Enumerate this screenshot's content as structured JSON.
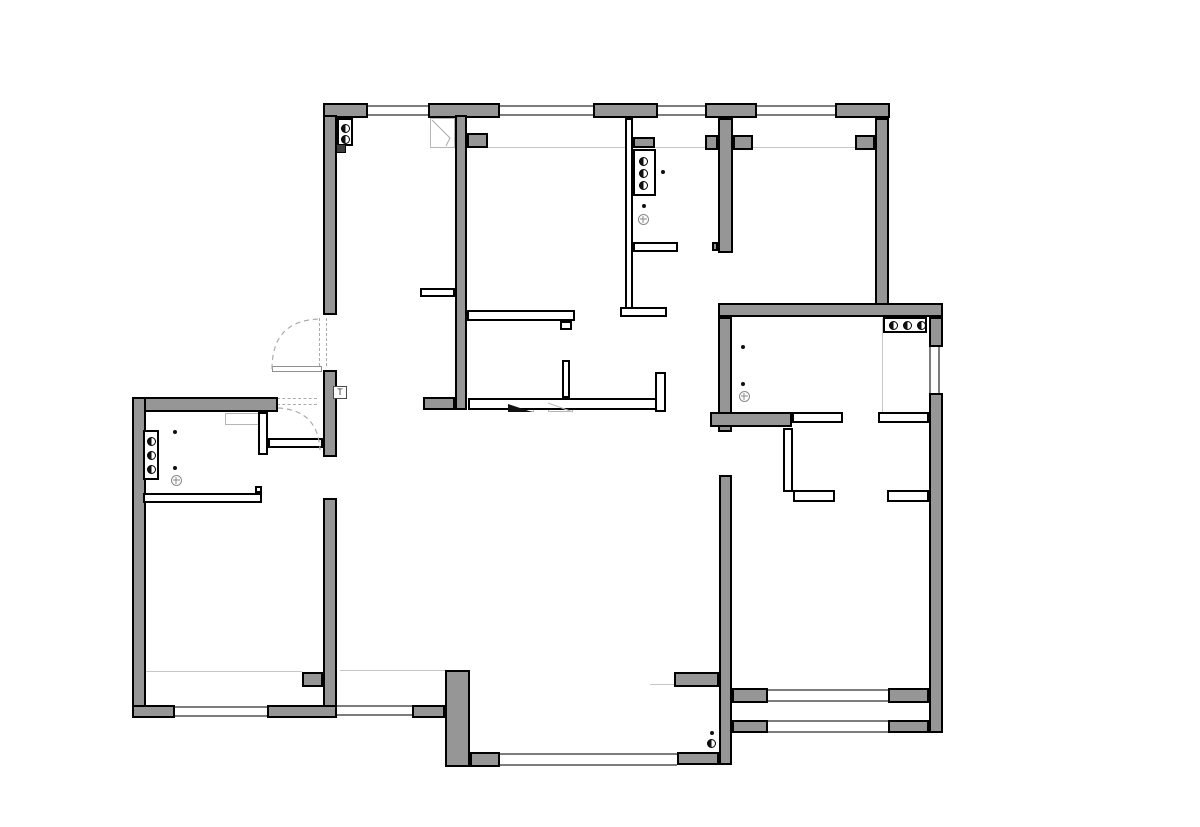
{
  "document": {
    "kind": "residential floor plan drawing",
    "canvas_w": 1200,
    "canvas_h": 827
  },
  "palette": {
    "wall_fill": "#969696",
    "wall_stroke": "#000000",
    "partition_fill": "#ffffff",
    "window_line": "#7d7d7d",
    "reference_line": "#c6c6c6",
    "dashed_line": "#ababab",
    "background": "#ffffff",
    "symbol_dark": "#111111"
  },
  "t_label": {
    "text": "T",
    "box": [
      333,
      386,
      14,
      13
    ]
  },
  "plan": {
    "walls": [
      [
        323,
        103,
        45,
        15
      ],
      [
        428,
        103,
        72,
        15
      ],
      [
        593,
        103,
        65,
        15
      ],
      [
        705,
        103,
        52,
        15
      ],
      [
        835,
        103,
        55,
        15
      ],
      [
        323,
        115,
        14,
        200
      ],
      [
        323,
        370,
        14,
        87
      ],
      [
        323,
        498,
        14,
        220
      ],
      [
        302,
        672,
        21,
        15
      ],
      [
        132,
        397,
        146,
        15
      ],
      [
        132,
        397,
        14,
        321
      ],
      [
        132,
        705,
        43,
        13
      ],
      [
        267,
        705,
        70,
        13
      ],
      [
        455,
        115,
        12,
        295
      ],
      [
        467,
        133,
        21,
        15
      ],
      [
        423,
        397,
        32,
        13
      ],
      [
        718,
        118,
        15,
        135
      ],
      [
        705,
        135,
        13,
        15
      ],
      [
        733,
        135,
        20,
        15
      ],
      [
        712,
        242,
        6,
        9
      ],
      [
        875,
        118,
        14,
        199
      ],
      [
        855,
        135,
        20,
        15
      ],
      [
        718,
        303,
        225,
        14
      ],
      [
        929,
        317,
        14,
        30
      ],
      [
        929,
        393,
        14,
        340
      ],
      [
        718,
        317,
        14,
        115
      ],
      [
        710,
        412,
        82,
        15
      ],
      [
        719,
        475,
        13,
        290
      ],
      [
        674,
        672,
        45,
        15
      ],
      [
        732,
        688,
        36,
        15
      ],
      [
        732,
        720,
        36,
        13
      ],
      [
        888,
        688,
        41,
        15
      ],
      [
        888,
        720,
        41,
        13
      ],
      [
        677,
        752,
        42,
        13
      ],
      [
        445,
        670,
        25,
        97
      ],
      [
        412,
        705,
        33,
        13
      ],
      [
        470,
        752,
        30,
        15
      ],
      [
        633,
        137,
        22,
        11
      ]
    ],
    "partitions": [
      [
        625,
        118,
        8,
        192
      ],
      [
        620,
        307,
        47,
        10
      ],
      [
        633,
        242,
        45,
        10
      ],
      [
        420,
        288,
        35,
        9
      ],
      [
        467,
        310,
        108,
        11
      ],
      [
        560,
        321,
        12,
        9
      ],
      [
        468,
        398,
        190,
        12
      ],
      [
        562,
        360,
        8,
        38
      ],
      [
        655,
        372,
        11,
        40
      ],
      [
        258,
        412,
        10,
        43
      ],
      [
        268,
        438,
        55,
        10
      ],
      [
        143,
        493,
        119,
        10
      ],
      [
        255,
        486,
        7,
        7
      ],
      [
        783,
        428,
        10,
        64
      ],
      [
        793,
        490,
        42,
        12
      ],
      [
        792,
        412,
        51,
        11
      ],
      [
        878,
        412,
        51,
        11
      ],
      [
        887,
        490,
        42,
        12
      ]
    ],
    "windows_h": [
      [
        368,
        105,
        60,
        11
      ],
      [
        500,
        105,
        93,
        11
      ],
      [
        658,
        105,
        47,
        11
      ],
      [
        757,
        105,
        78,
        11
      ],
      [
        175,
        706,
        92,
        11
      ],
      [
        337,
        705,
        75,
        11
      ],
      [
        500,
        753,
        177,
        13
      ],
      [
        768,
        689,
        120,
        13
      ],
      [
        768,
        720,
        120,
        13
      ]
    ],
    "windows_v": [
      [
        929,
        347,
        11,
        46
      ]
    ],
    "reference_lines": [
      {
        "x": 488,
        "y": 147,
        "len": 384,
        "dir": "h"
      },
      {
        "x": 145,
        "y": 671,
        "len": 157,
        "dir": "h"
      },
      {
        "x": 340,
        "y": 670,
        "len": 105,
        "dir": "h"
      },
      {
        "x": 882,
        "y": 318,
        "len": 94,
        "dir": "v"
      },
      {
        "x": 650,
        "y": 684,
        "len": 25,
        "dir": "h"
      }
    ],
    "dashed_lines": [
      {
        "x": 319,
        "y": 318,
        "len": 48,
        "dir": "v"
      },
      {
        "x": 326,
        "y": 318,
        "len": 48,
        "dir": "v"
      },
      {
        "x": 277,
        "y": 398,
        "len": 40,
        "dir": "h"
      },
      {
        "x": 277,
        "y": 404,
        "len": 40,
        "dir": "h"
      }
    ],
    "door_leaves": [
      [
        272,
        366,
        50,
        6
      ]
    ],
    "door_arcs": [
      "M272,369 Q272,319 322,319",
      "M278,408 Q318,410 320,450"
    ],
    "light_boxes": [
      {
        "name": "flue-box",
        "box": [
          430,
          118,
          25,
          30
        ]
      },
      {
        "name": "appliance-box",
        "box": [
          225,
          413,
          35,
          12
        ]
      },
      {
        "name": "threshold-box",
        "box": [
          508,
          403,
          26,
          9
        ]
      },
      {
        "name": "hatch-box",
        "box": [
          548,
          403,
          25,
          9
        ]
      }
    ],
    "overlay_paths": [
      {
        "name": "flue-line",
        "d": "M432,120 L450,138 L446,146",
        "stroke": "#aaaaaa"
      },
      {
        "name": "hatch-line",
        "d": "M548,403 L573,412",
        "stroke": "#bbbbbb"
      }
    ],
    "threshold_triangle": "508,404 508,412 532,412",
    "radiators": [
      {
        "box": [
          337,
          118,
          16,
          28
        ],
        "circles": [
          [
            345,
            128
          ],
          [
            345,
            139
          ]
        ]
      },
      {
        "box": [
          633,
          149,
          23,
          47
        ],
        "circles": [
          [
            643,
            161
          ],
          [
            643,
            173
          ],
          [
            643,
            185
          ]
        ]
      },
      {
        "box": [
          883,
          317,
          44,
          16
        ],
        "circles": [
          [
            893,
            325
          ],
          [
            907,
            325
          ],
          [
            921,
            325
          ]
        ]
      },
      {
        "box": [
          143,
          430,
          16,
          50
        ],
        "circles": [
          [
            151,
            441
          ],
          [
            151,
            455
          ],
          [
            151,
            469
          ]
        ]
      },
      {
        "box": null,
        "circles": [
          [
            711,
            743
          ]
        ]
      }
    ],
    "dots": [
      [
        663,
        172
      ],
      [
        644,
        206
      ],
      [
        743,
        347
      ],
      [
        743,
        384
      ],
      [
        175,
        432
      ],
      [
        175,
        468
      ],
      [
        712,
        733
      ]
    ],
    "drains": [
      [
        643,
        219
      ],
      [
        744,
        396
      ],
      [
        176,
        480
      ]
    ],
    "meter_box": [
      336,
      144,
      10,
      9
    ]
  }
}
